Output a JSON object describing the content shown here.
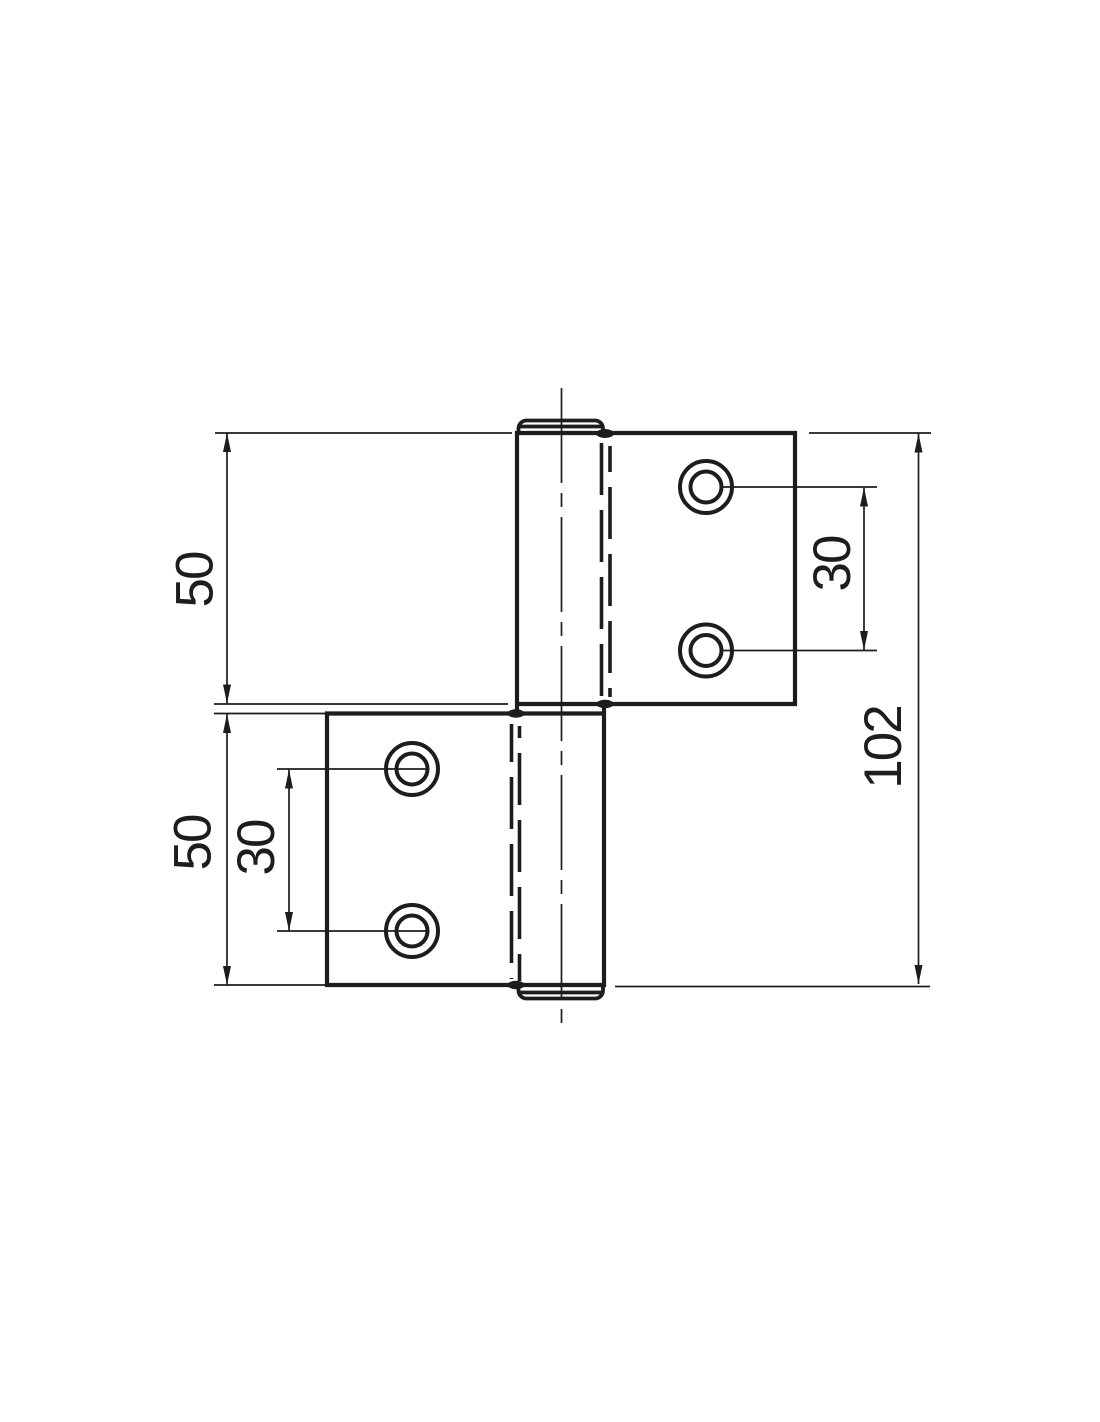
{
  "drawing": {
    "type": "technical-drawing",
    "subject": "flag hinge, side elevation with two leaves, pin barrel and screw holes",
    "units": "mm",
    "line_color": "#1d1d1b",
    "background_color": "#ffffff",
    "dimensions": {
      "top_leaf_height": "50",
      "bottom_leaf_height": "50",
      "top_hole_spacing": "30",
      "bottom_hole_spacing": "30",
      "overall_height": "102"
    }
  }
}
